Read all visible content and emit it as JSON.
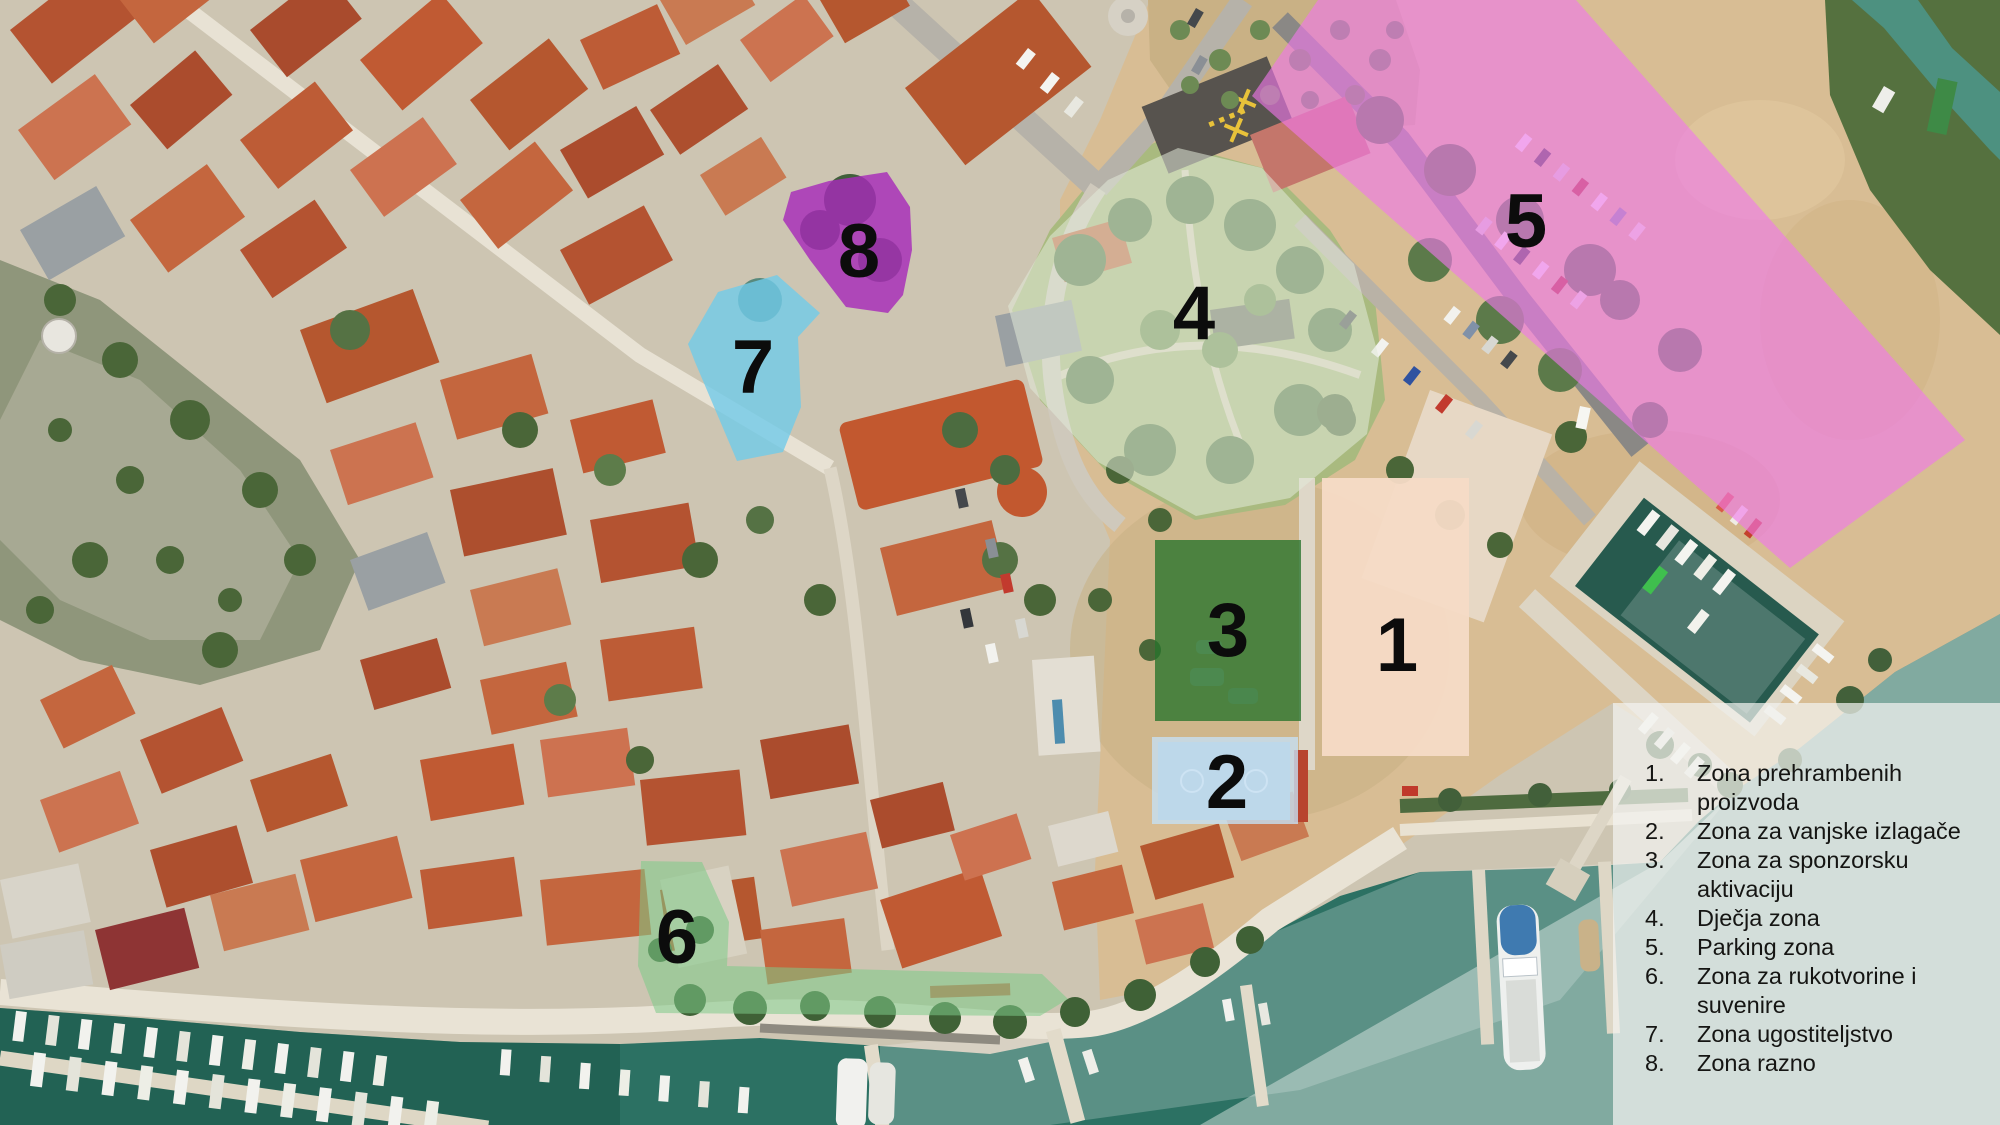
{
  "zones": [
    {
      "number": "1",
      "num_display": "1.",
      "label": "Zona prehrambenih proizvoda",
      "color": "rgba(246,219,198,0.95)"
    },
    {
      "number": "2",
      "num_display": "2.",
      "label": "Zona za vanjske izlagače",
      "color": "rgba(198,224,242,0.8)"
    },
    {
      "number": "3",
      "num_display": "3.",
      "label": "Zona za sponzorsku aktivaciju",
      "color": "rgba(39,115,44,0.78)"
    },
    {
      "number": "4",
      "num_display": "4.",
      "label": "Dječja zona",
      "color": "rgba(225,234,216,0.55)"
    },
    {
      "number": "5",
      "num_display": "5.",
      "label": "Parking zona",
      "color": "rgba(240,120,235,0.62)"
    },
    {
      "number": "6",
      "num_display": "6.",
      "label": "Zona za rukotvorine i suvenire",
      "color": "rgba(126,203,136,0.55)"
    },
    {
      "number": "7",
      "num_display": "7.",
      "label": "Zona ugostiteljstvo",
      "color": "rgba(113,202,232,0.8)"
    },
    {
      "number": "8",
      "num_display": "8.",
      "label": "Zona razno",
      "color": "rgba(167,43,186,0.82)"
    }
  ]
}
